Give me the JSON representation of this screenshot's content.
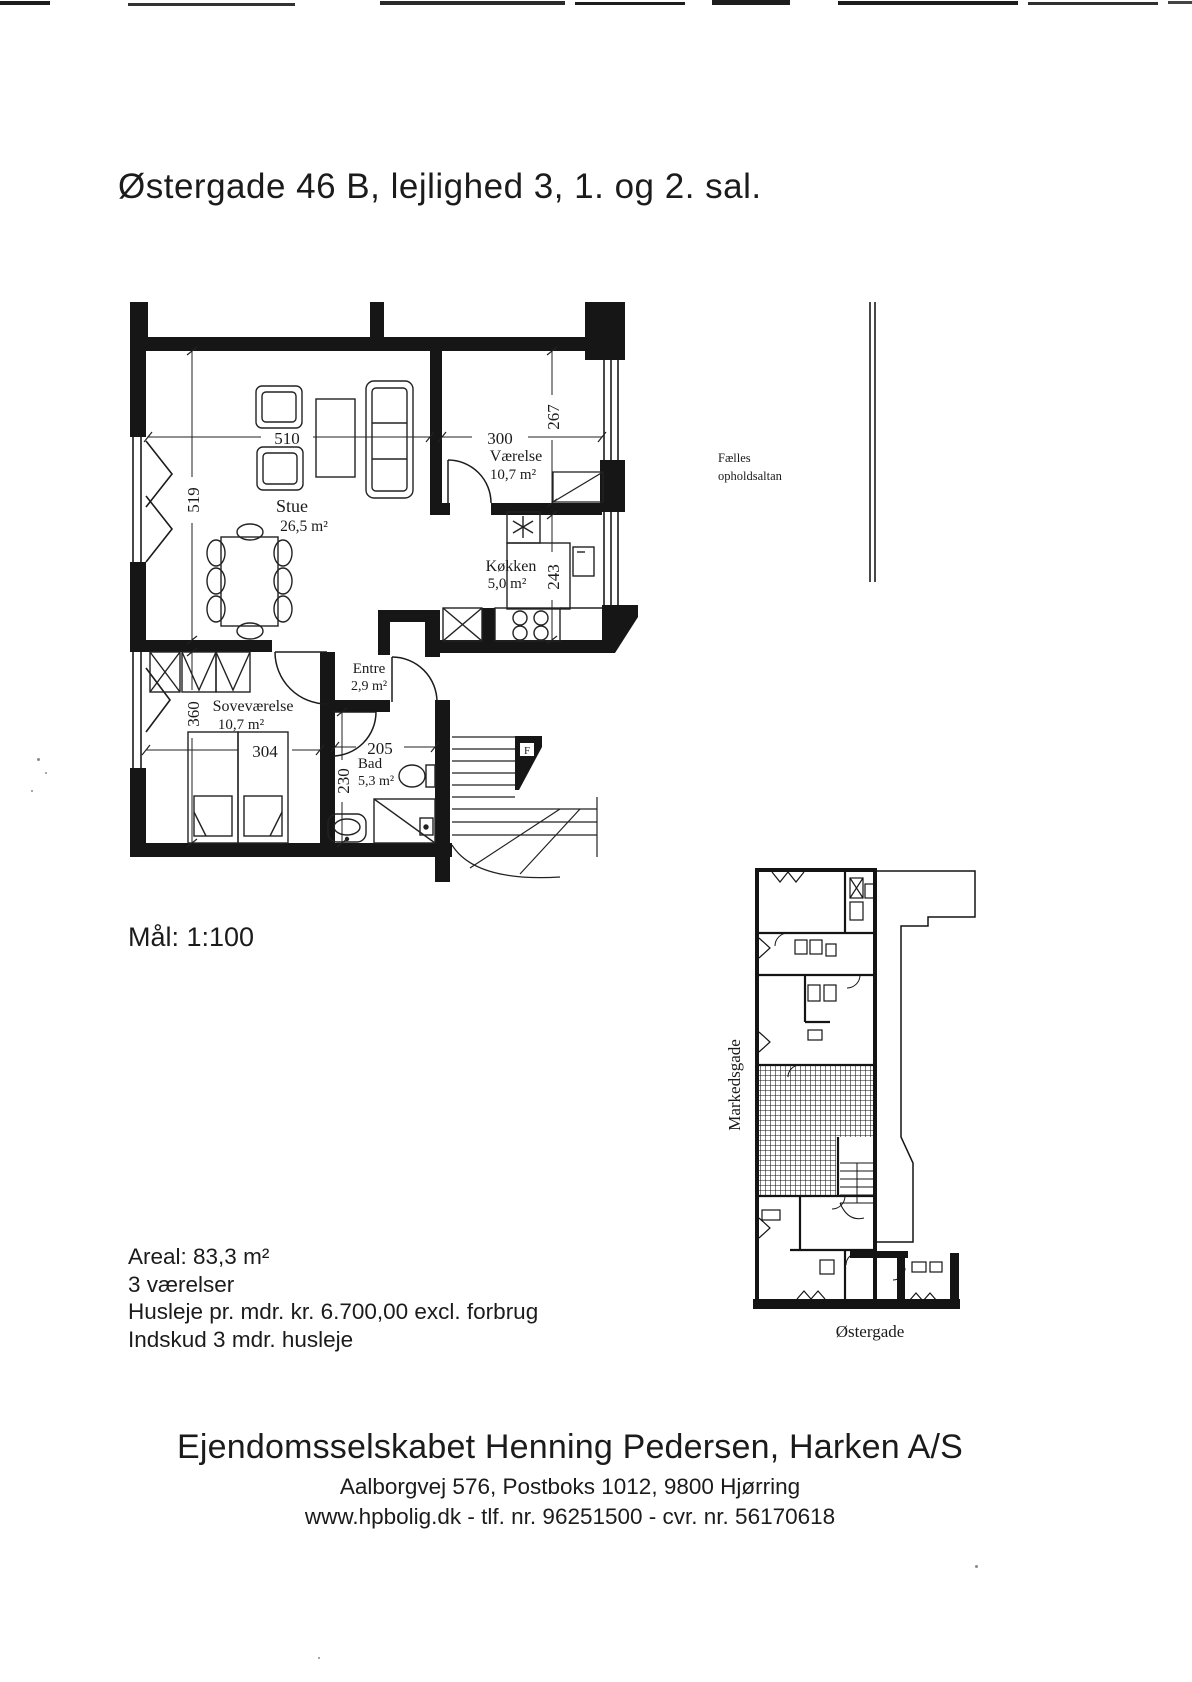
{
  "document": {
    "title": "Østergade 46 B, lejlighed 3, 1. og 2. sal.",
    "scale": "Mål: 1:100",
    "facts": {
      "area": "Areal: 83,3 m²",
      "rooms": "3 værelser",
      "rent": "Husleje pr. mdr. kr. 6.700,00 excl. forbrug",
      "deposit": "Indskud 3 mdr. husleje"
    },
    "footer": {
      "company": "Ejendomsselskabet Henning Pedersen, Harken A/S",
      "address": "Aalborgvej 576, Postboks 1012, 9800 Hjørring",
      "contact": "www.hpbolig.dk - tlf. nr. 96251500 - cvr. nr. 56170618"
    }
  },
  "floor_plan": {
    "rooms": [
      {
        "name": "Stue",
        "area": "26,5 m²"
      },
      {
        "name": "Værelse",
        "area": "10,7 m²"
      },
      {
        "name": "Køkken",
        "area": "5,0 m²"
      },
      {
        "name": "Entre",
        "area": "2,9 m²"
      },
      {
        "name": "Soveværelse",
        "area": "10,7 m²"
      },
      {
        "name": "Bad",
        "area": "5,3 m²"
      }
    ],
    "dimensions_cm": {
      "stue_width": "510",
      "stue_depth": "519",
      "vaerelse_width": "300",
      "vaerelse_window": "267",
      "koekken_depth": "243",
      "sovevaerelse_width": "304",
      "sovevaerelse_depth": "360",
      "bad_width": "205",
      "bad_depth": "230"
    },
    "balcony_note_line1": "Fælles",
    "balcony_note_line2": "opholdsaltan",
    "stair_mark": "F"
  },
  "site_plan": {
    "street_west": "Markedsgade",
    "street_south": "Østergade"
  },
  "colors": {
    "ink": "#1b1b1b",
    "paper": "#ffffff"
  }
}
